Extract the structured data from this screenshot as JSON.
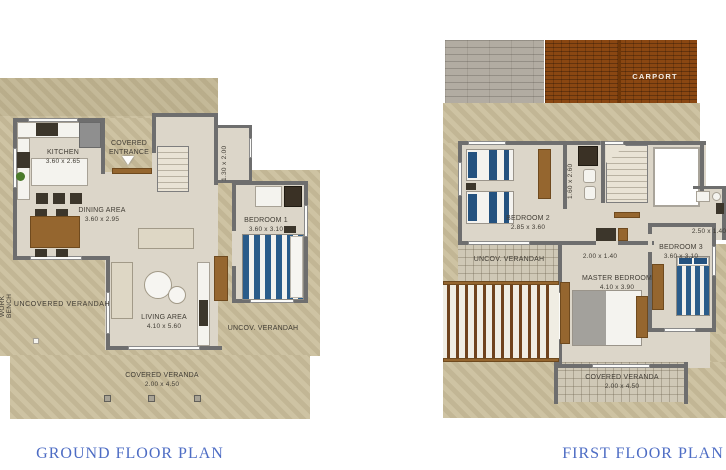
{
  "colors": {
    "title_blue": "#4d6cc4",
    "terrain_beige": "#cbbf9d",
    "wall_gray": "#6e6e6e",
    "carport_brown": "#8a4712",
    "bed_blue": "#24527f",
    "wood_brown": "#95662f"
  },
  "ground_floor": {
    "title": "GROUND FLOOR PLAN",
    "rooms": {
      "kitchen": {
        "name": "KITCHEN",
        "dims": "3.60 x 2.65"
      },
      "dining": {
        "name": "DINING AREA",
        "dims": "3.60 x 2.95"
      },
      "living": {
        "name": "LIVING AREA",
        "dims": "4.10 x 5.60"
      },
      "bedroom1": {
        "name": "BEDROOM 1",
        "dims": "3.60 x 3.10"
      },
      "entrance": {
        "name": "COVERED ENTRANCE"
      },
      "bath": {
        "dims": "1.30 x 2.00"
      },
      "covered_veranda": {
        "name": "COVERED VERANDA",
        "dims": "2.00 x 4.50"
      },
      "uncovered_verandah": {
        "name": "UNCOVERED VERANDAH"
      },
      "uncov_verandah": {
        "name": "UNCOV. VERANDAH"
      },
      "work_bench": {
        "name": "WORK BENCH"
      }
    }
  },
  "first_floor": {
    "title": "FIRST FLOOR PLAN",
    "rooms": {
      "carport": {
        "name": "CARPORT"
      },
      "bedroom2": {
        "name": "BEDROOM 2",
        "dims": "2.85 x 3.60"
      },
      "bedroom3": {
        "name": "BEDROOM 3",
        "dims": "3.60 x 3.10"
      },
      "master": {
        "name": "MASTER BEDROOM",
        "dims": "4.10 x 3.90"
      },
      "bath1": {
        "dims": "1.60 x 2.60"
      },
      "bath2": {
        "dims": "2.50 x 1.40"
      },
      "closet": {
        "dims": "2.00 x 1.40"
      },
      "uncov_verandah": {
        "name": "UNCOV. VERANDAH"
      },
      "covered_veranda": {
        "name": "COVERED VERANDA",
        "dims": "2.00 x 4.50"
      }
    }
  }
}
